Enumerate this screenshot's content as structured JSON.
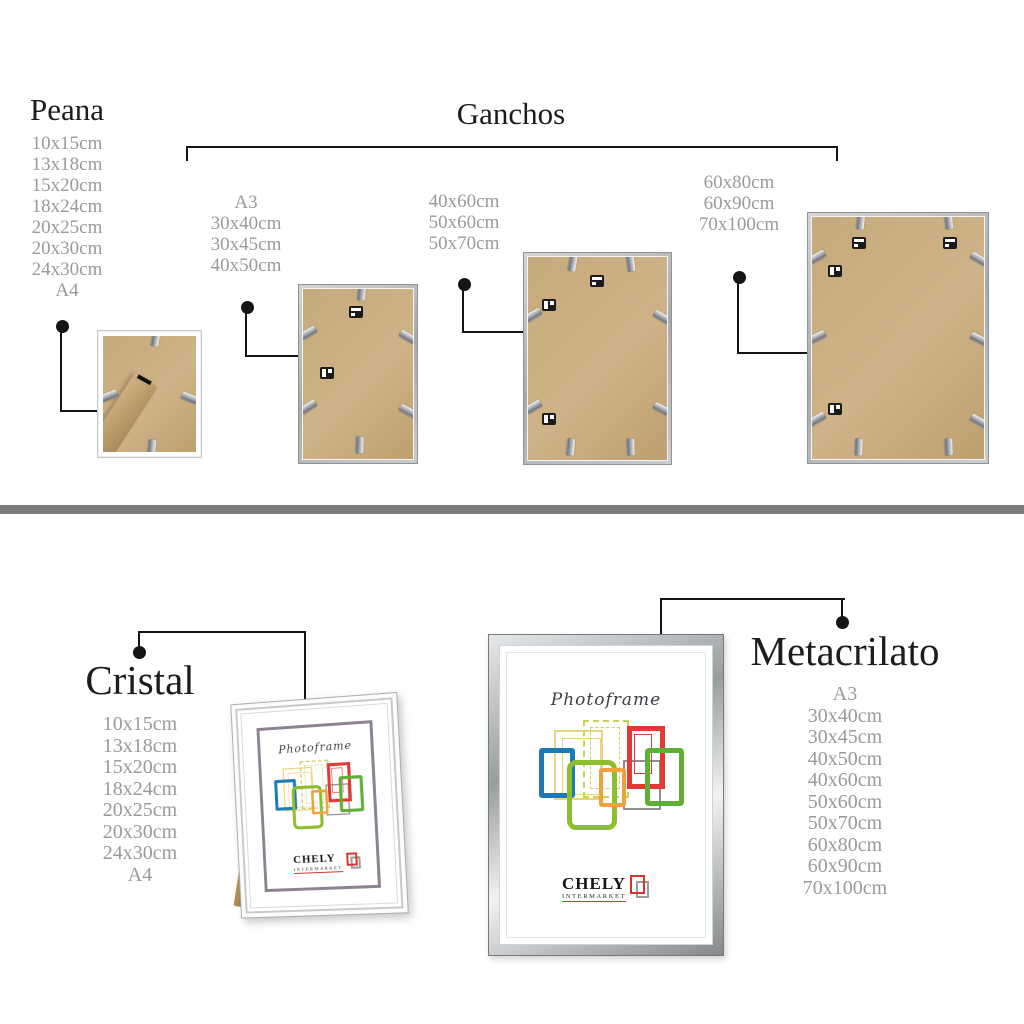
{
  "colors": {
    "heading": "#1c1c1c",
    "list_gray": "#9a9a9a",
    "divider": "#7b7b7b",
    "kraft": "#c6aa7c",
    "line": "#151515",
    "brand_red": "#d6352d",
    "mat_purple": "#8d8292"
  },
  "sections": {
    "peana": {
      "title": "Peana",
      "sizes": [
        "10x15cm",
        "13x18cm",
        "15x20cm",
        "18x24cm",
        "20x25cm",
        "20x30cm",
        "24x30cm",
        "A4"
      ]
    },
    "ganchos": {
      "title": "Ganchos",
      "size_groups": [
        [
          "A3",
          "30x40cm",
          "30x45cm",
          "40x50cm"
        ],
        [
          "40x60cm",
          "50x60cm",
          "50x70cm"
        ],
        [
          "60x80cm",
          "60x90cm",
          "70x100cm"
        ]
      ]
    },
    "cristal": {
      "title": "Cristal",
      "sizes": [
        "10x15cm",
        "13x18cm",
        "15x20cm",
        "18x24cm",
        "20x25cm",
        "20x30cm",
        "24x30cm",
        "A4"
      ]
    },
    "metacrilato": {
      "title": "Metacrilato",
      "sizes": [
        "A3",
        "30x40cm",
        "30x45cm",
        "40x50cm",
        "40x60cm",
        "50x60cm",
        "50x70cm",
        "60x80cm",
        "60x90cm",
        "70x100cm"
      ]
    }
  },
  "frame_front": {
    "script_label": "Photoframe",
    "brand_name": "CHELY",
    "brand_sub": "INTERMARKET"
  }
}
